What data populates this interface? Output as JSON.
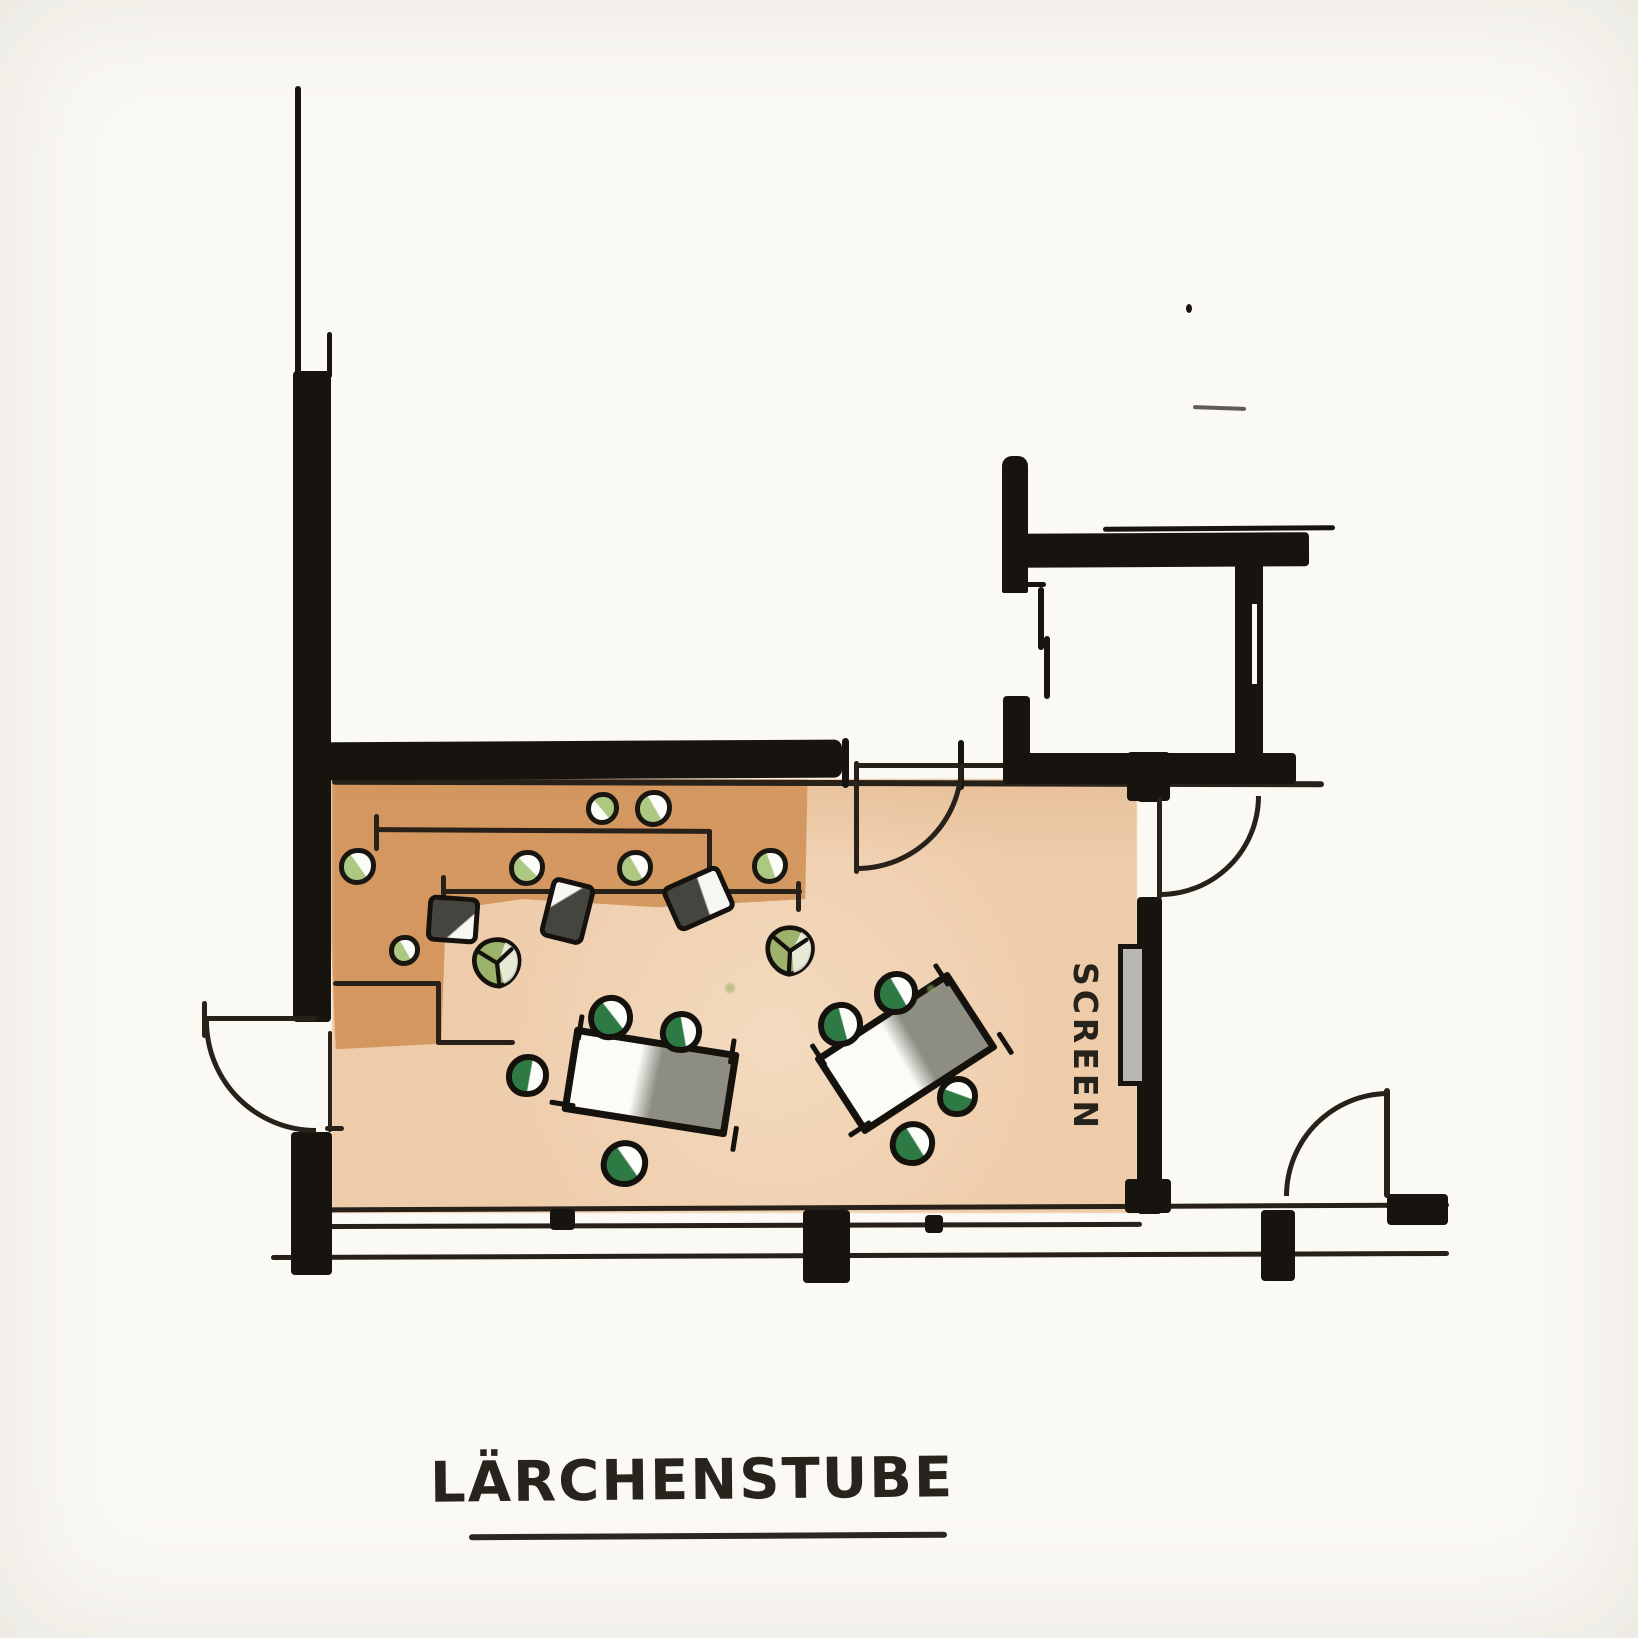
{
  "title": {
    "text": "LÄRCHENSTUBE"
  },
  "labels": {
    "screen": "SCREEN"
  },
  "colors": {
    "paper": "#fbf9f4",
    "ink": "#17130f",
    "line": "#28211a",
    "floor": "#eeccaa",
    "floorDark": "#d2935b",
    "tableGray": "#8d8d83",
    "tableWhite": "#fbfbf7",
    "chairGreen": "#2d7a45",
    "stoolGreen": "#adc981",
    "plantGreen": "#9db26a",
    "screenGray": "#b8b8b3"
  },
  "plan": {
    "room_name": "Lärchenstube",
    "tables": [
      {
        "x": 650,
        "y": 1082,
        "w": 167,
        "h": 86,
        "rot": 9,
        "gray_pct": 50
      },
      {
        "x": 906,
        "y": 1053,
        "w": 160,
        "h": 92,
        "rot": -33,
        "gray_pct": 55
      }
    ],
    "chairs": [
      {
        "x": 610,
        "y": 1017,
        "d": 45,
        "rot": -8,
        "wa": 60
      },
      {
        "x": 681,
        "y": 1032,
        "d": 42,
        "rot": 5,
        "wa": 75
      },
      {
        "x": 527,
        "y": 1075,
        "d": 43,
        "rot": 0,
        "wa": 100
      },
      {
        "x": 624,
        "y": 1163,
        "d": 47,
        "rot": 10,
        "wa": 45
      },
      {
        "x": 840,
        "y": 1024,
        "d": 45,
        "rot": -5,
        "wa": 80
      },
      {
        "x": 896,
        "y": 993,
        "d": 44,
        "rot": 0,
        "wa": 60
      },
      {
        "x": 957,
        "y": 1096,
        "d": 41,
        "rot": 0,
        "wa": 20
      },
      {
        "x": 912,
        "y": 1143,
        "d": 45,
        "rot": 8,
        "wa": 50
      }
    ],
    "stools": [
      {
        "x": 357,
        "y": 866,
        "d": 37,
        "wa": 55
      },
      {
        "x": 404,
        "y": 950,
        "d": 31,
        "wa": 60
      },
      {
        "x": 527,
        "y": 868,
        "d": 36,
        "wa": 45
      },
      {
        "x": 635,
        "y": 868,
        "d": 36,
        "wa": 60
      },
      {
        "x": 770,
        "y": 866,
        "d": 36,
        "wa": 70
      },
      {
        "x": 602,
        "y": 808,
        "d": 33,
        "wa": 230
      },
      {
        "x": 653,
        "y": 808,
        "d": 37,
        "wa": 60
      }
    ],
    "cushions": [
      {
        "x": 453,
        "y": 919,
        "w": 52,
        "h": 47,
        "rot": 4,
        "side": "br"
      },
      {
        "x": 567,
        "y": 911,
        "w": 45,
        "h": 62,
        "rot": 14,
        "side": "tl"
      },
      {
        "x": 698,
        "y": 898,
        "w": 63,
        "h": 49,
        "rot": -24,
        "side": "r"
      }
    ],
    "plants": [
      {
        "x": 497,
        "y": 963,
        "s": 56,
        "rot": -6
      },
      {
        "x": 790,
        "y": 951,
        "s": 56,
        "rot": 3
      }
    ],
    "specks": [
      {
        "x": 730,
        "y": 988,
        "d": 10
      },
      {
        "x": 931,
        "y": 989,
        "d": 8
      }
    ]
  }
}
